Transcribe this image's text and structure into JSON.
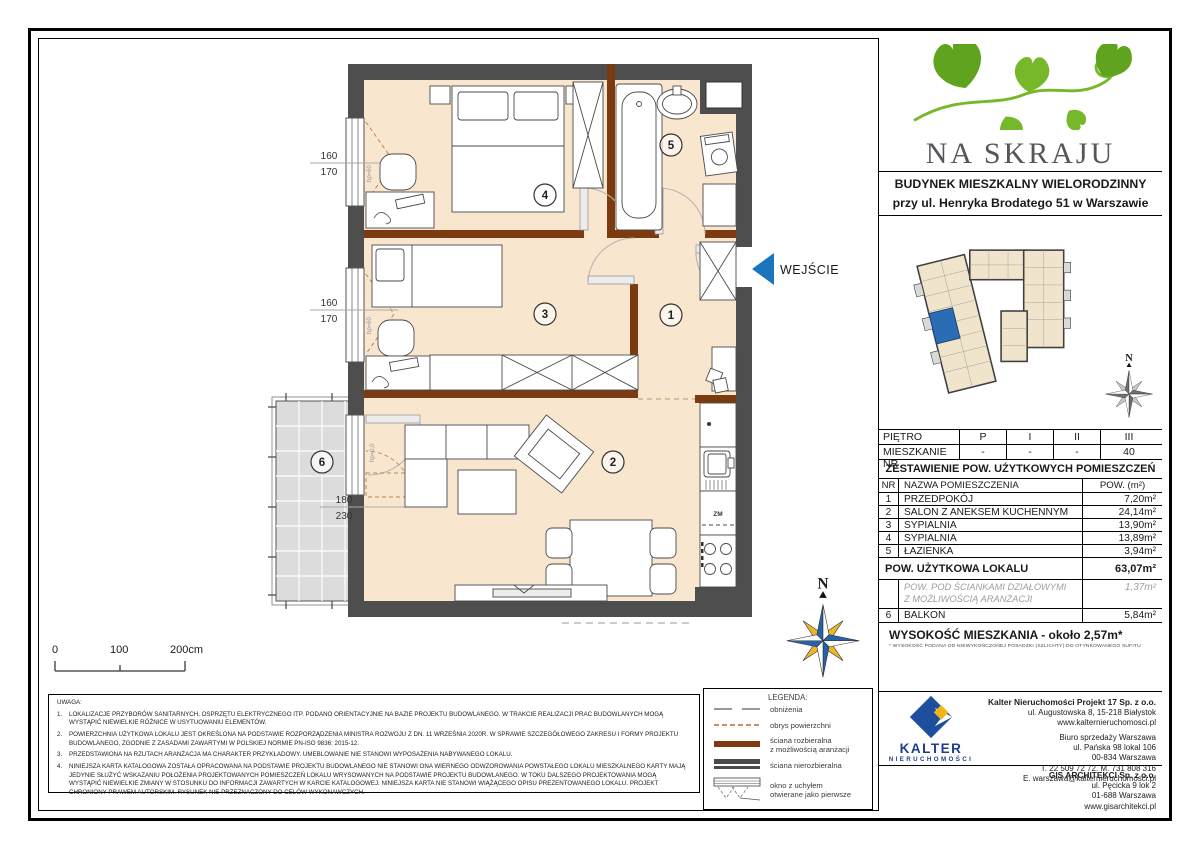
{
  "header": {
    "project_name": "NA SKRAJU",
    "building_line1": "BUDYNEK MIESZKALNY WIELORODZINNY",
    "building_line2": "przy ul. Henryka Brodatego 51 w Warszawie"
  },
  "floor_table": {
    "floor_label": "PIĘTRO",
    "floors": [
      "P",
      "I",
      "II",
      "III"
    ],
    "unit_label": "MIESZKANIE NR",
    "units": [
      "-",
      "-",
      "-",
      "40"
    ]
  },
  "rooms_table": {
    "title": "ZESTAWIENIE POW. UŻYTKOWYCH POMIESZCZEŃ",
    "col_nr": "NR",
    "col_name": "NAZWA POMIESZCZENIA",
    "col_area": "POW. (m²)",
    "rows": [
      {
        "nr": "1",
        "name": "PRZEDPOKÓJ",
        "area": "7,20m²"
      },
      {
        "nr": "2",
        "name": "SALON Z ANEKSEM KUCHENNYM",
        "area": "24,14m²"
      },
      {
        "nr": "3",
        "name": "SYPIALNIA",
        "area": "13,90m²"
      },
      {
        "nr": "4",
        "name": "SYPIALNIA",
        "area": "13,89m²"
      },
      {
        "nr": "5",
        "name": "ŁAZIENKA",
        "area": "3,94m²"
      }
    ],
    "total_label": "POW. UŻYTKOWA LOKALU",
    "total_value": "63,07m²",
    "partition_line1": "POW. POD ŚCIANKAMI DZIAŁOWYMI",
    "partition_line2": "Z MOŻLIWOŚCIĄ ARANŻACJI",
    "partition_value": "1,37m²",
    "balcony_nr": "6",
    "balcony_label": "BALKON",
    "balcony_value": "5,84m²",
    "height_label": "WYSOKOŚĆ MIESZKANIA - około 2,57m*",
    "height_footnote": "* WYSOKOŚĆ PODANA OD NIEWYKOŃCZONEJ POSADZKI (SZLICHTY) DO OTYNKOWANEGO SUFITU"
  },
  "plan": {
    "entrance_label": "WEJŚCIE",
    "north": "N",
    "rooms": {
      "r1": "1",
      "r2": "2",
      "r3": "3",
      "r4": "4",
      "r5": "5",
      "r6": "6"
    },
    "dims": {
      "w1a": "160",
      "w1b": "170",
      "w2a": "160",
      "w2b": "170",
      "da": "180",
      "db": "230"
    },
    "labels": {
      "zm": "ZM",
      "hp_window": "hp=60",
      "hp_door": "hp=0,0"
    }
  },
  "scale": {
    "t0": "0",
    "t1": "100",
    "t2": "200cm"
  },
  "notes": {
    "title": "UWAGA:",
    "items": [
      "LOKALIZACJE PRZYBORÓW SANITARNYCH, OSPRZĘTU ELEKTRYCZNEGO ITP. PODANO ORIENTACYJNIE NA BAZIE PROJEKTU BUDOWLANEGO. W TRAKCIE REALIZACJI PRAC BUDOWLANYCH MOGĄ WYSTĄPIĆ NIEWIELKIE RÓŻNICE W USYTUOWANIU ELEMENTÓW.",
      "POWIERZCHNIA UŻYTKOWA LOKALU JEST OKREŚLONA NA PODSTAWIE ROZPORZĄDZENIA MINISTRA ROZWOJU Z DN. 11 WRZEŚNIA 2020R. W SPRAWIE SZCZEGÓŁOWEGO ZAKRESU I FORMY PROJEKTU BUDOWLANEGO, ZGODNIE Z ZASADAMI ZAWARTYMI W POLSKIEJ NORMIE PN-ISO 9836: 2015-12.",
      "PRZEDSTAWIONA NA RZUTACH ARANŻACJA MA CHARAKTER PRZYKŁADOWY. UMEBLOWANIE NIE STANOWI WYPOSAŻENIA NABYWANEGO LOKALU.",
      "NINIEJSZA KARTA KATALOGOWA ZOSTAŁA OPRACOWANA NA PODSTAWIE PROJEKTU BUDOWLANEGO NIE STANOWI ONA WIERNEGO ODWZOROWANIA POWSTAŁEGO LOKALU MIESZKALNEGO KARTY MAJĄ JEDYNIE SŁUŻYĆ WSKAZANIU POŁOŻENIA PROJEKTOWANYCH POMIESZCZEŃ LOKALU WRYSOWANYCH NA PODSTAWIE PROJEKTU BUDOWLANEGO. W TOKU DALSZEGO PROJEKTOWANIA MOGĄ WYSTĄPIĆ NIEWIELKIE ZMIANY W STOSUNKU DO INFORMACJI ZAWARTYCH W KARCIE KATALOGOWEJ. NINIEJSZA KARTA NIE STANOWI WIĄŻĄCEGO OPISU PREZENTOWANEGO LOKALU. PROJEKT CHRONIONY PRAWEM AUTORSKIM. RYSUNEK NIE PRZEZNACZONY DO CELÓW WYKONAWCZYCH."
    ]
  },
  "legend": {
    "title": "LEGENDA:",
    "items": [
      {
        "line1": "obniżenia"
      },
      {
        "line1": "obrys powierzchni"
      },
      {
        "line1": "ściana rozbieralna",
        "line2": "z możliwością aranżacji"
      },
      {
        "line1": "ściana nierozbieralna"
      },
      {
        "line1": "okno z uchyłem",
        "line2": "otwierane jako pierwsze"
      }
    ]
  },
  "footer": {
    "kalter_name": "KALTER",
    "kalter_sub": "nieruchomości",
    "company": [
      "Kalter Nieruchomości Projekt 17 Sp. z o.o.",
      "ul. Augustowska 8, 15-218 Białystok",
      "www.kalternieruchomosci.pl"
    ],
    "office": [
      "Biuro sprzedaży Warszawa",
      "ul. Pańska 98 lokal 106",
      "00-834 Warszawa",
      "T. 22 509 72 72. M. 731 808 316",
      "E. warszawa@kalternieruchomosci.pl"
    ],
    "architect": [
      "GIS ARCHITEKCI Sp. z o.o.",
      "ul. Pęcicka 9 lok 2",
      "01-688 Warszawa",
      "www.gisarchitekci.pl"
    ]
  },
  "colors": {
    "floor": "#f9e6cf",
    "wall": "#4e4e4e",
    "partition_wall": "#7c3a10",
    "accent_blue": "#1b75bc",
    "brand_green": "#76b82a",
    "kalter_navy": "#1e3d8f",
    "kalter_yellow": "#f3b517",
    "balcony_gray": "#dcdcdc"
  }
}
